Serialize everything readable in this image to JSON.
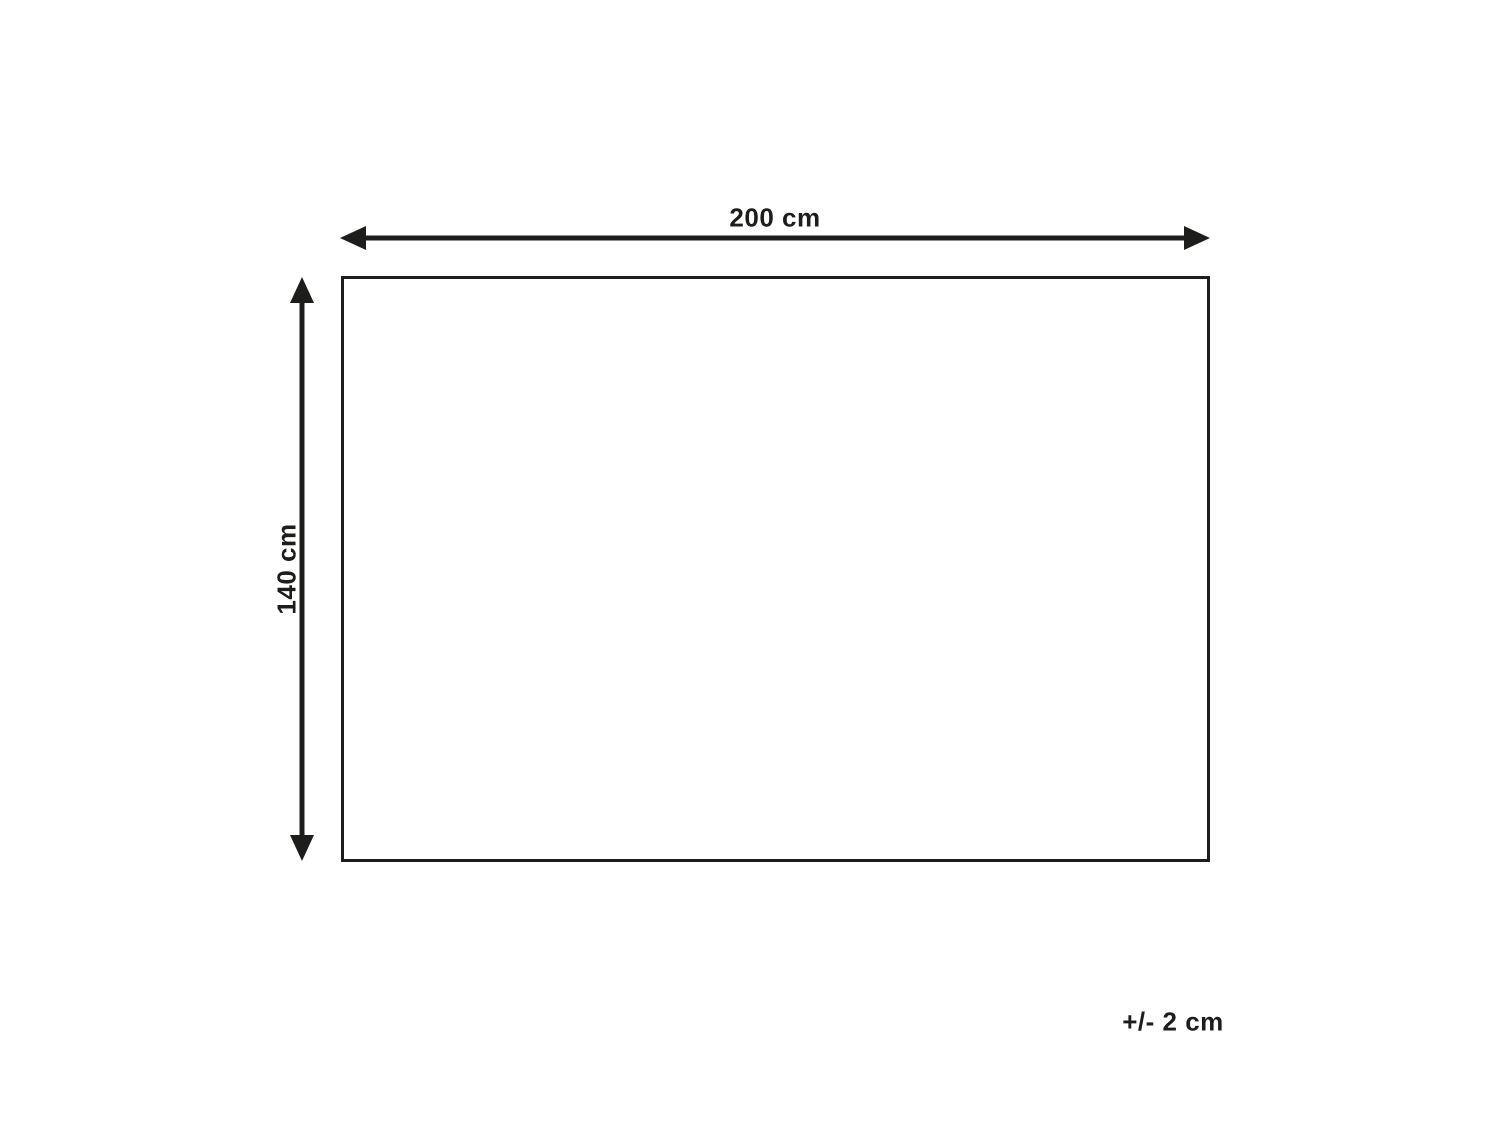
{
  "diagram": {
    "title": "product-dimension-diagram",
    "width_label": "200 cm",
    "height_label": "140 cm",
    "tolerance_label": "+/- 2 cm",
    "shape": "rectangle",
    "line_color": "#1d1d1b",
    "background_color": "#ffffff"
  }
}
